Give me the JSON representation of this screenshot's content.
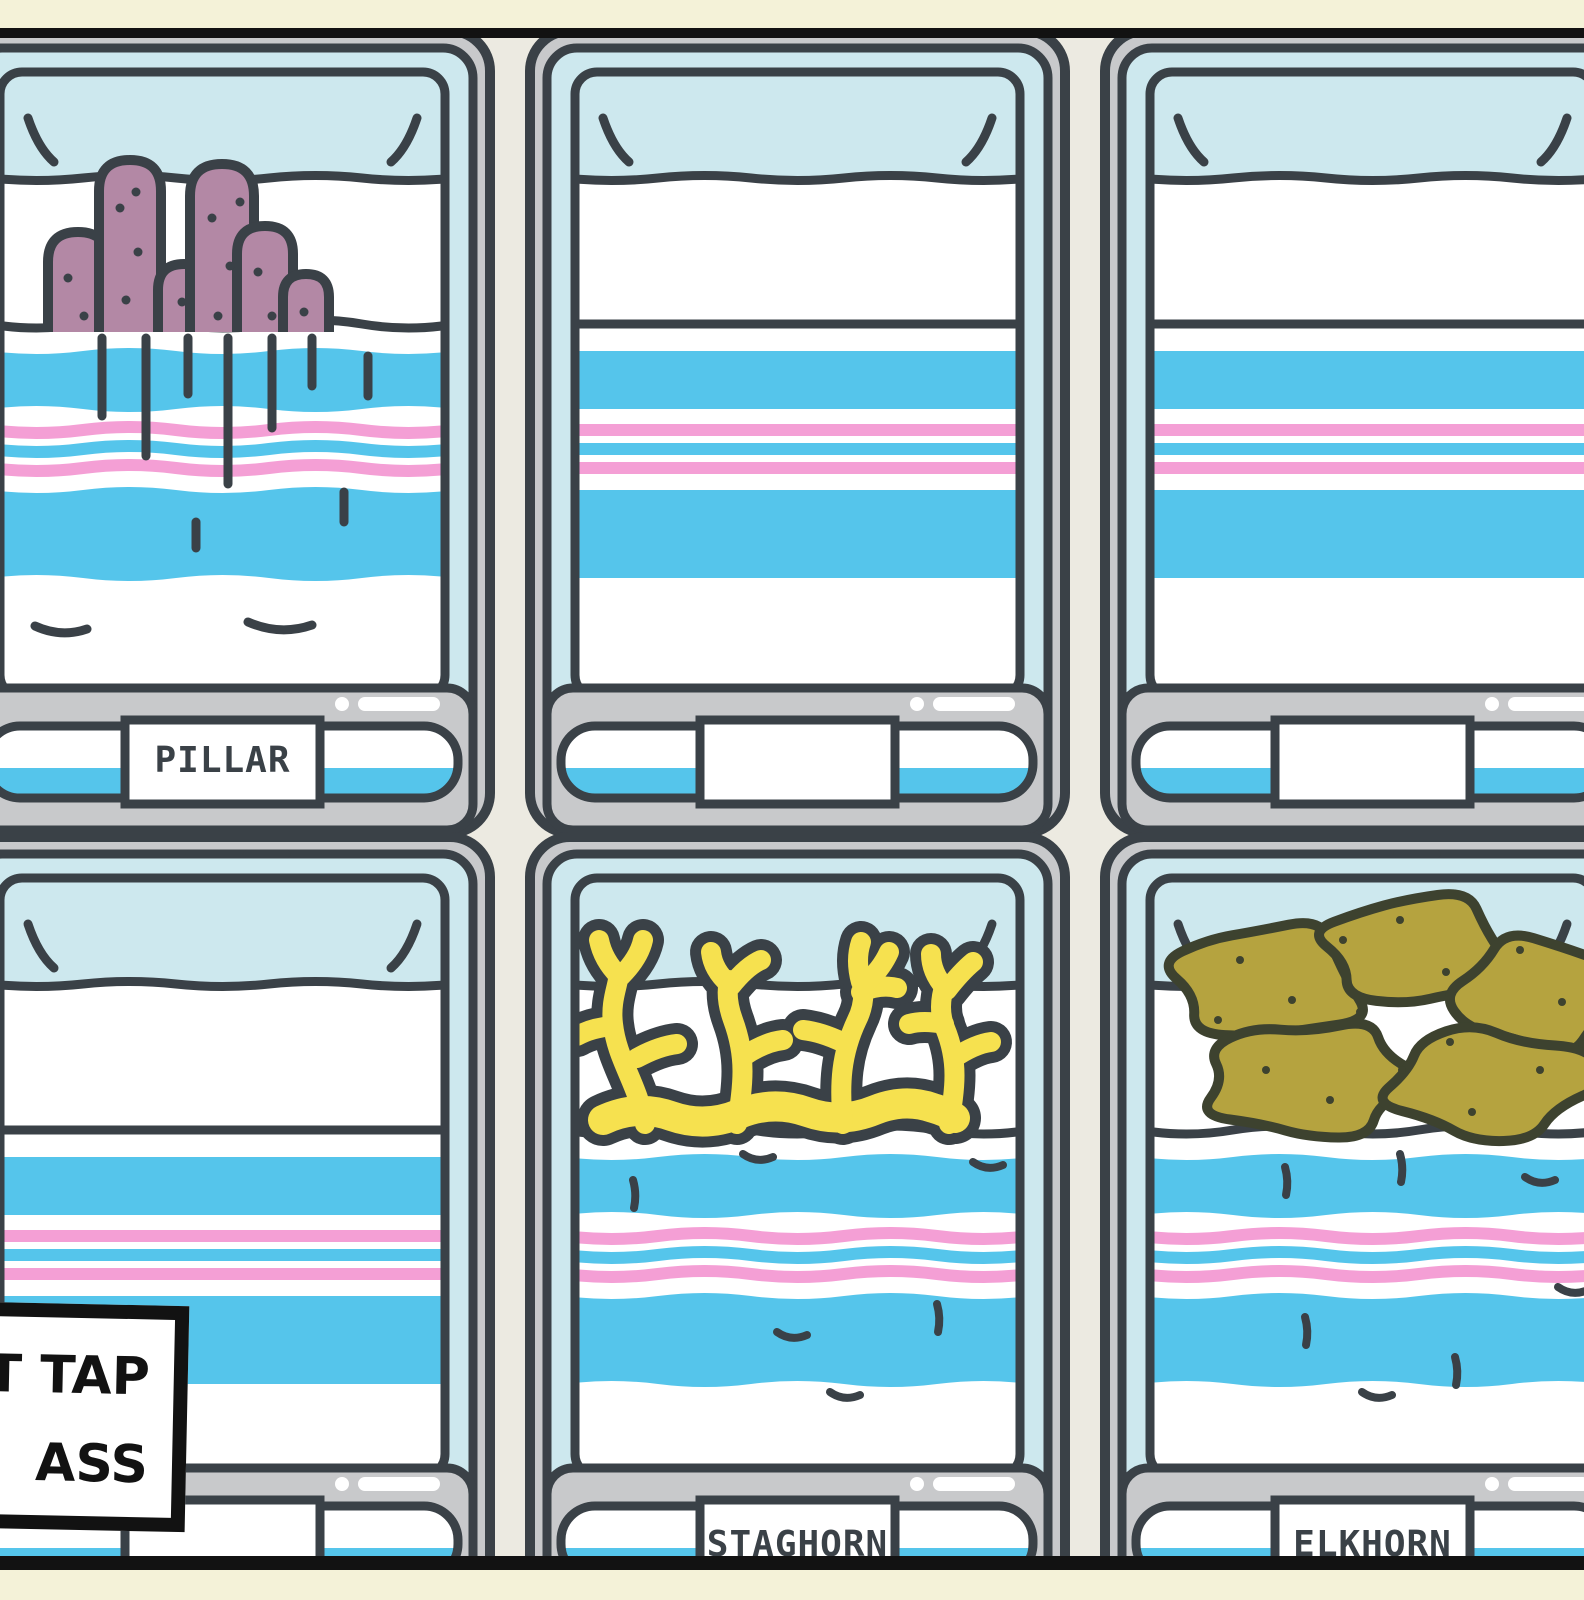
{
  "scene": {
    "background": "#F4F2D8",
    "frame_bar_color": "#121212",
    "wall_color": "#ECEAE1"
  },
  "palette": {
    "outline": "#3A4147",
    "outline_olive": "#3D422F",
    "tank_glass": "#CDE8EE",
    "stand_gray": "#C8C9CB",
    "water_blue": "#55C5EB",
    "stripe_pink": "#F49FD5",
    "white": "#FFFFFF",
    "coral_pillar": "#B388A5",
    "coral_staghorn": "#F6E14F",
    "coral_elkhorn": "#B5A33F",
    "label_text": "#3A4147"
  },
  "tanks": [
    {
      "id": "pillar",
      "label": "PILLAR",
      "coral": "pillar",
      "water": "wavy",
      "row": 0,
      "col": 0
    },
    {
      "id": "empty-top-middle",
      "label": "",
      "coral": "none",
      "water": "straight",
      "row": 0,
      "col": 1
    },
    {
      "id": "empty-top-right",
      "label": "",
      "coral": "none",
      "water": "straight",
      "row": 0,
      "col": 2
    },
    {
      "id": "empty-bottom-left",
      "label": "",
      "coral": "none",
      "water": "straight",
      "row": 1,
      "col": 0
    },
    {
      "id": "staghorn",
      "label": "STAGHORN",
      "coral": "staghorn",
      "water": "wavy",
      "row": 1,
      "col": 1
    },
    {
      "id": "elkhorn",
      "label": "ELKHORN",
      "coral": "elkhorn",
      "water": "wavy",
      "row": 1,
      "col": 2
    }
  ],
  "sign": {
    "lines": [
      "T TAP",
      "ASS"
    ],
    "background": "#FFFFFF",
    "border_color": "#121212",
    "text_color": "#121212"
  }
}
